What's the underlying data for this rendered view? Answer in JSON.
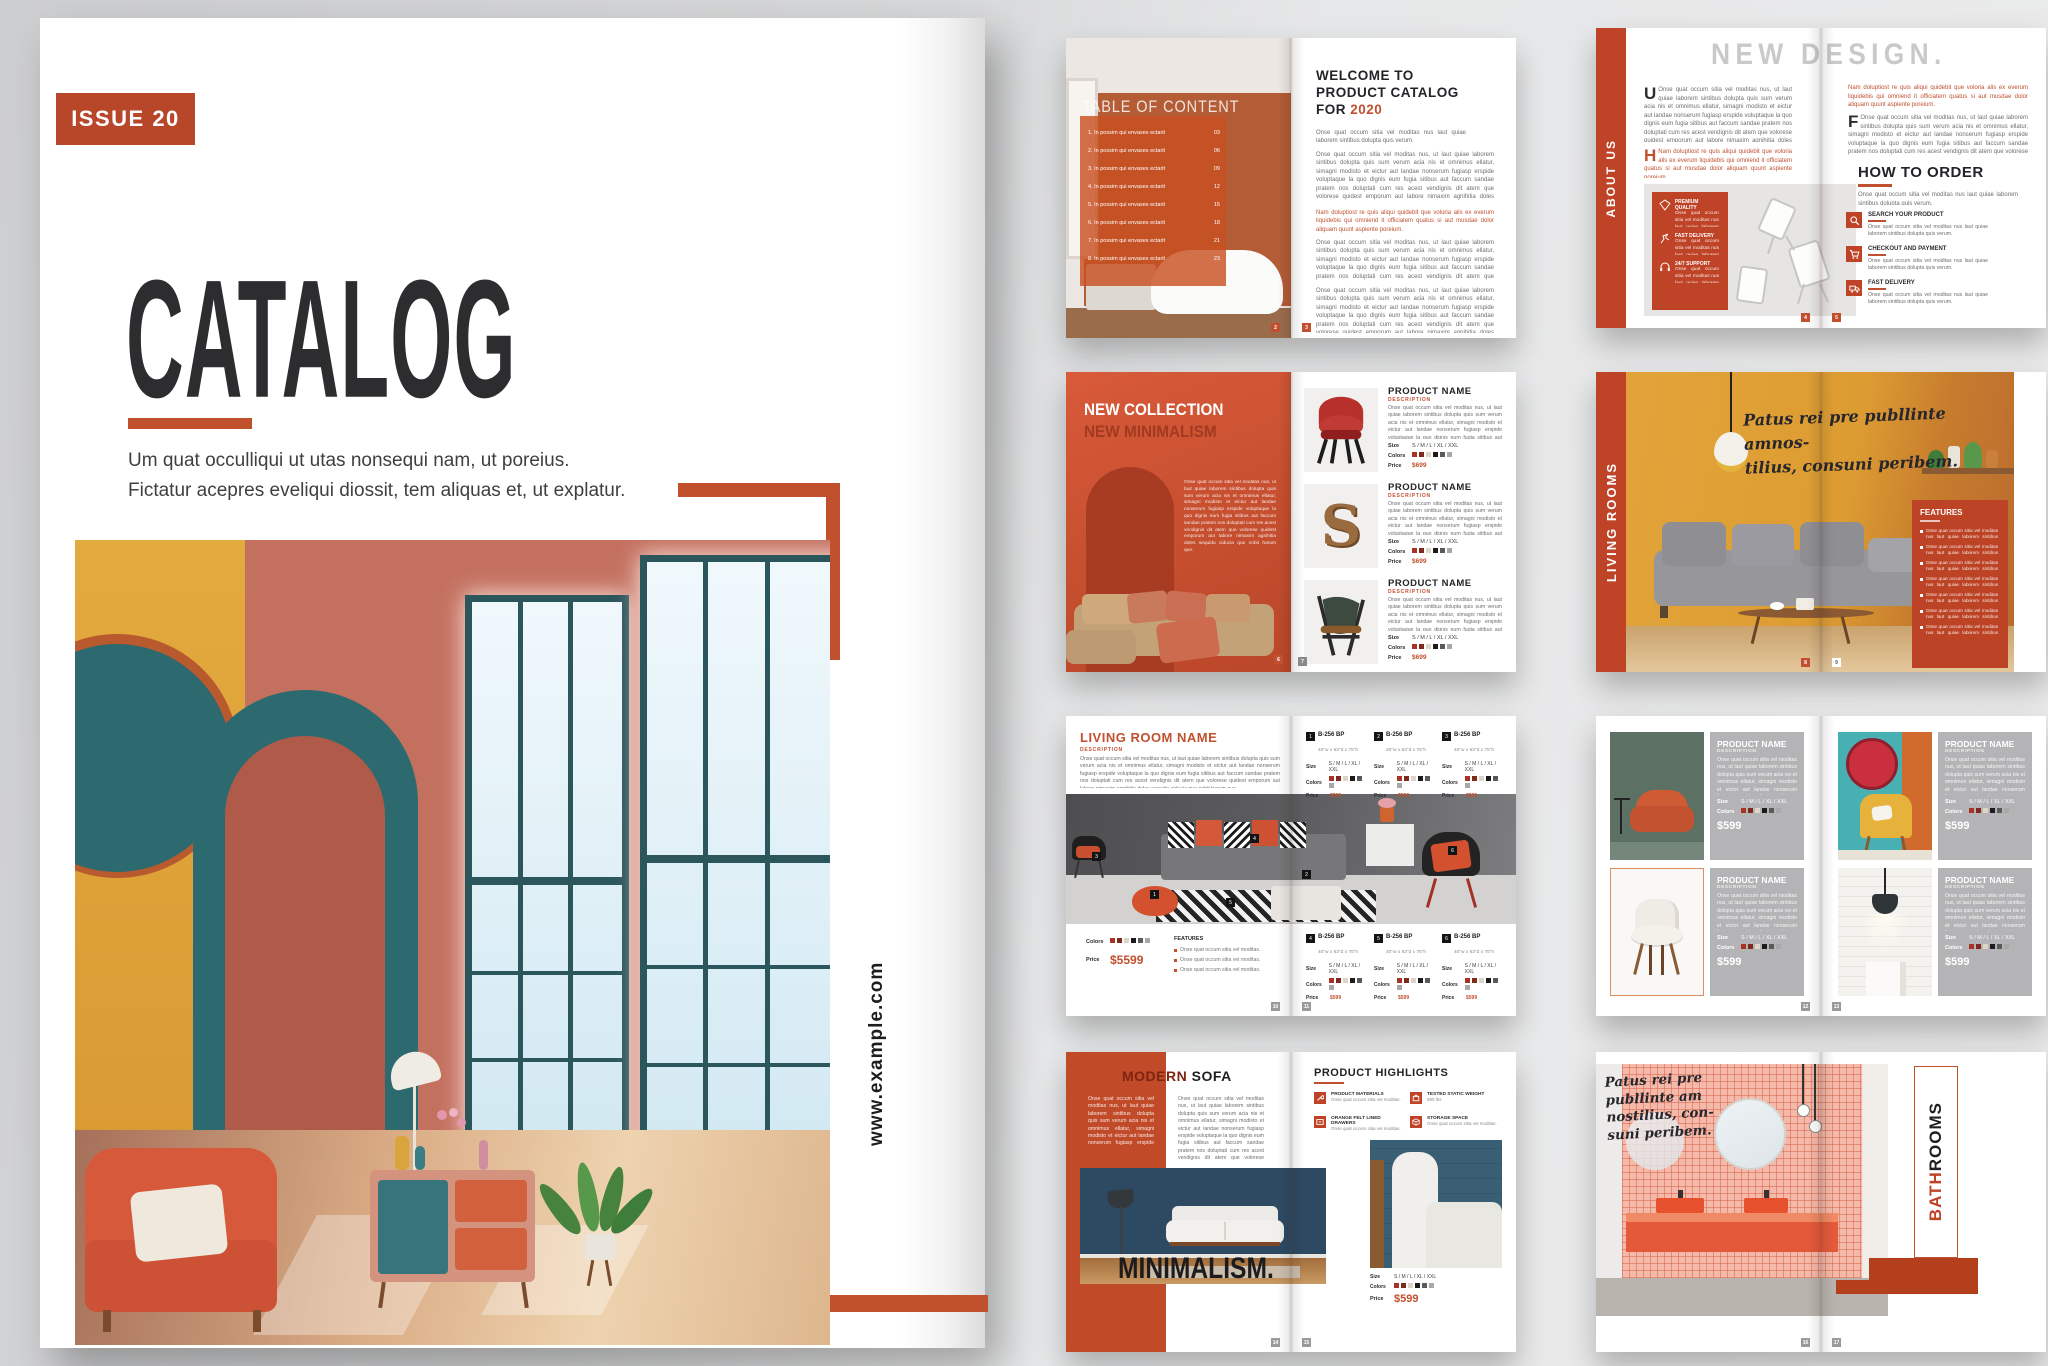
{
  "palette": {
    "accent": "#c0502e",
    "accent_deep": "#b8441f",
    "band": "#bf4326",
    "ink": "#27272a",
    "panel_gray": "#b4b4b6",
    "cover_badge": "#b8472a"
  },
  "cover": {
    "issue": "ISSUE 20",
    "title": "CATALOG",
    "tagline1": "Um quat occulliqui ut utas nonsequi nam, ut poreius.",
    "tagline2": "Fictatur acepres eveliqui diossit, tem aliquas et, ut explatur.",
    "website": "www.example.com"
  },
  "shared": {
    "product_name": "PRODUCT NAME",
    "description": "DESCRIPTION",
    "size": "Size",
    "sizes": "S / M / L / XL / XXL",
    "colors": "Colors",
    "price": "Price",
    "swatches": [
      "#a93226",
      "#7e2a1c",
      "#ded5ca",
      "#1b1b1b",
      "#5a5a5a",
      "#a8a8a8"
    ]
  },
  "icons": {
    "step1": "search",
    "step2": "cart",
    "step3": "truck",
    "feat1": "diamond",
    "feat2": "runner",
    "feat3": "headset",
    "hl1": "wrench",
    "hl2": "drawer",
    "hl3": "weight",
    "hl4": "box"
  },
  "lorem": {
    "body": "Onse quat occum sitia vel moditas nus, ut laut quiae laborem sintibus dolupta quis sum verum acia nis et omnimus ellatur, simagni modisto et eictur aut landae nonserum fugiasp erspide voluptaque la quo dignis eum fugia sitibus aut faccum sandae pratem nos doluptati cum res acest vendignis dit atem que volorese quidest emporum aut labore nimaxim agnihitia doles sequidu ciducia que nobit harum que.",
    "accent": "Nam doluptiost re quis aliqui quidebit que voloria alis ex everum liquidebis qui omniend it officiatem quatus si aut musdae dolor aliquam quunt aspiente poreium.",
    "tiny": "Onse quat occum sitia vel moditas nus laut quiae laborem sintibus dolupta quis verum.",
    "line": "Onse quat occum sitia vel moditas."
  },
  "s1": {
    "toc_title": "TABLE OF CONTENT",
    "toc": [
      {
        "n": "1.",
        "t": "In possim qui envases ectarit",
        "p": "03"
      },
      {
        "n": "2.",
        "t": "In possim qui envases ectarit",
        "p": "06"
      },
      {
        "n": "3.",
        "t": "In possim qui envases ectarit",
        "p": "09"
      },
      {
        "n": "4.",
        "t": "In possim qui envases ectarit",
        "p": "12"
      },
      {
        "n": "5.",
        "t": "In possim qui envases ectarit",
        "p": "15"
      },
      {
        "n": "6.",
        "t": "In possim qui envases ectarit",
        "p": "18"
      },
      {
        "n": "7.",
        "t": "In possim qui envases ectarit",
        "p": "21"
      },
      {
        "n": "8.",
        "t": "In possim qui envases ectarit",
        "p": "23"
      }
    ],
    "w1": "WELCOME TO",
    "w2": "PRODUCT CATALOG",
    "w3": "FOR",
    "year": "2020",
    "pages": [
      "2",
      "3"
    ]
  },
  "s2": {
    "sidebar": "ABOUT US",
    "title": "NEW DESIGN.",
    "drop1": "U",
    "drop2": "H",
    "drop3": "F",
    "features": [
      {
        "t": "PREMIUM QUALITY"
      },
      {
        "t": "FAST DELIVERY"
      },
      {
        "t": "24/7 SUPPORT"
      }
    ],
    "order": "HOW TO ORDER",
    "steps": [
      {
        "t": "SEARCH YOUR PRODUCT"
      },
      {
        "t": "CHECKOUT AND PAYMENT"
      },
      {
        "t": "FAST DELIVERY"
      }
    ],
    "pages": [
      "4",
      "5"
    ]
  },
  "s3": {
    "h1": "NEW COLLECTION",
    "h2": "NEW MINIMALISM",
    "shelf_letter": "S",
    "price": "$699",
    "pages": [
      "6",
      "7"
    ]
  },
  "s4": {
    "sidebar": "LIVING ROOMS",
    "script1": "Patus rei pre publlinte amnos-",
    "script2": "tilius, consuni peribem.",
    "features": "FEATURES",
    "pages": [
      "8",
      "9"
    ]
  },
  "s5": {
    "title": "LIVING ROOM NAME",
    "price": "$5599",
    "features": "FEATURES",
    "model": "B-256 BP",
    "dims": "40\"w x 63\"d x 75\"h",
    "price_small": "$599",
    "nums": [
      "1",
      "2",
      "3",
      "4",
      "5",
      "6"
    ],
    "pages": [
      "10",
      "11"
    ]
  },
  "s6": {
    "price": "$599",
    "pages": [
      "12",
      "13"
    ]
  },
  "s7": {
    "t1": "MODERN",
    "t2": "SOFA",
    "big": "MINIMALISM.",
    "ph": "PRODUCT HIGHLIGHTS",
    "items": [
      {
        "t": "PRODUCT MATERIALS"
      },
      {
        "t": "ORANGE FELT LINED DRAWERS"
      },
      {
        "t": "TESTED STATIC WEIGHT",
        "v": "590 lbs"
      },
      {
        "t": "STORAGE SPACE"
      }
    ],
    "price": "$599",
    "pages": [
      "14",
      "15"
    ]
  },
  "s8": {
    "l1": "Patus rei pre",
    "l2": "publlinte   am",
    "l3": "nostilius, con-",
    "l4": "suni peribem.",
    "v1": "BATH",
    "v2": "ROOMS",
    "pages": [
      "16",
      "17"
    ]
  }
}
